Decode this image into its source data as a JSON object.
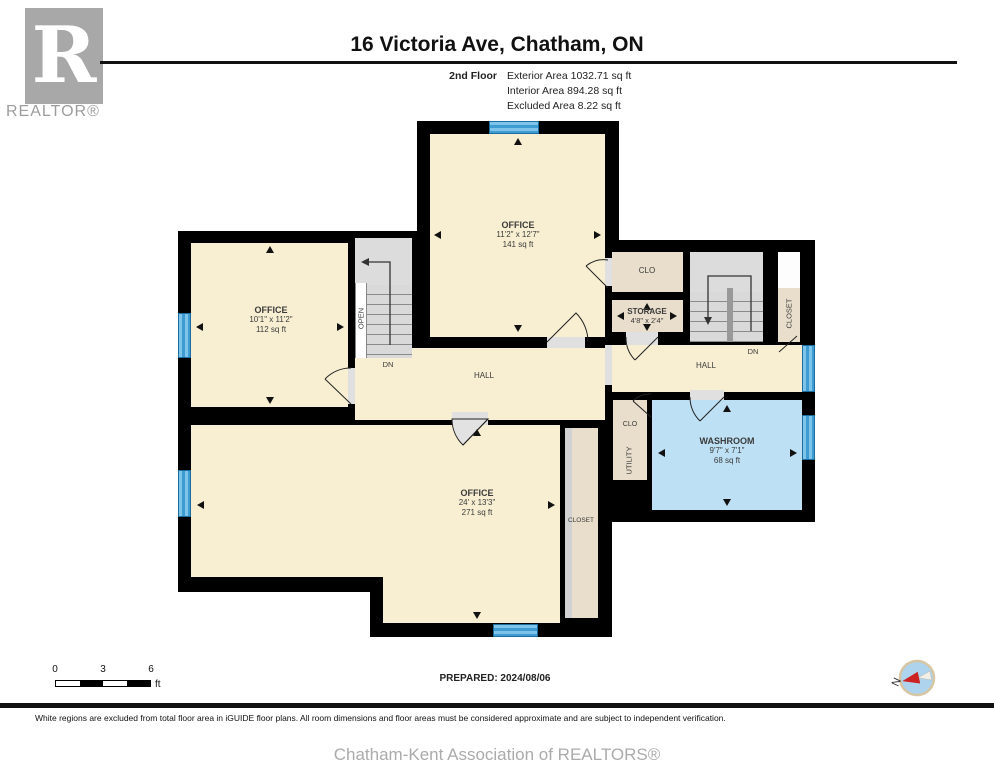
{
  "header": {
    "logo_r": "R",
    "logo_text": "REALTOR®",
    "title": "16 Victoria Ave, Chatham, ON",
    "floor_label": "2nd Floor",
    "area_lines": [
      "Exterior Area 1032.71 sq ft",
      "Interior Area 894.28 sq ft",
      "Excluded Area 8.22 sq ft"
    ]
  },
  "rooms": {
    "office_top": {
      "name": "OFFICE",
      "dims": "11'2\" x 12'7\"",
      "area": "141 sq ft"
    },
    "office_left": {
      "name": "OFFICE",
      "dims": "10'1\" x 11'2\"",
      "area": "112 sq ft"
    },
    "office_bottom": {
      "name": "OFFICE",
      "dims": "24' x 13'3\"",
      "area": "271 sq ft"
    },
    "washroom": {
      "name": "WASHROOM",
      "dims": "9'7\" x 7'1\"",
      "area": "68 sq ft"
    },
    "storage": {
      "name": "STORAGE",
      "dims": "4'8\" x 2'4\""
    },
    "clo_top": "CLO",
    "clo_small": "CLO",
    "utility": "UTILITY",
    "closet_right": "CLOSET",
    "closet_bottom": "CLOSET",
    "hall_left": "HALL",
    "hall_right": "HALL",
    "open": "OPEN",
    "dn_left": "DN",
    "dn_right": "DN"
  },
  "scale_bar": {
    "ticks": [
      "0",
      "3",
      "6"
    ],
    "unit": "ft"
  },
  "compass": {
    "north_label": "N"
  },
  "footer": {
    "prepared": "PREPARED: 2024/08/06",
    "disclaimer": "White regions are excluded from total floor area in iGUIDE floor plans. All room dimensions and floor areas must be considered approximate and are subject to independent verification.",
    "association": "Chatham-Kent Association of REALTORS®"
  },
  "colors": {
    "wall": "#000000",
    "room_fill": "#f8efd2",
    "closet_fill": "#e8decb",
    "washroom_fill": "#bee0f4",
    "window_blue": "#3f9cd3",
    "stair_fill": "#dcdcdc",
    "compass_red": "#cc2222"
  }
}
